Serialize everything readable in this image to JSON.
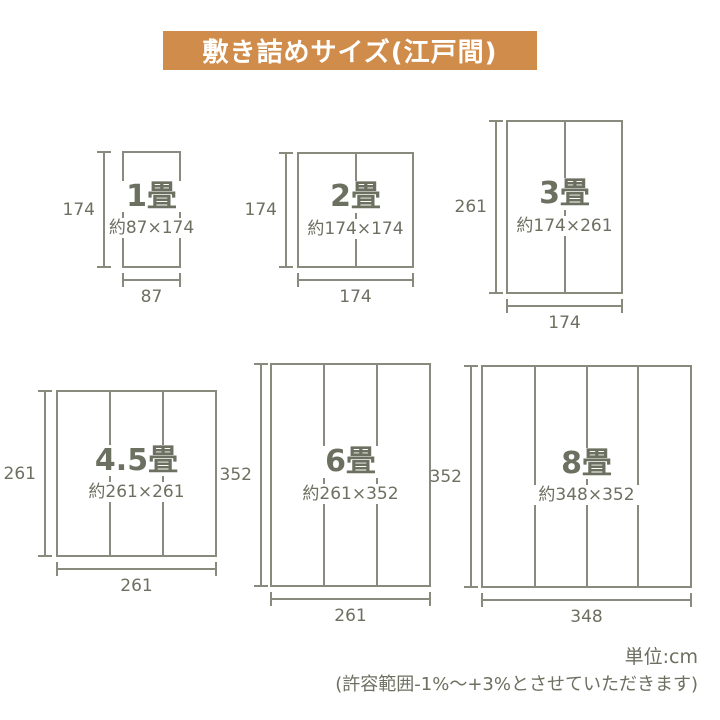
{
  "title": "敷き詰めサイズ(江戸間)",
  "colors": {
    "banner_bg": "#d08c4a",
    "title_text": "#ffffff",
    "line": "#878a7c",
    "text": "#6c7060"
  },
  "diagrams": [
    {
      "label": "1畳",
      "size": "約87×174",
      "side_cm": "174",
      "bottom_cm": "87",
      "columns": 1
    },
    {
      "label": "2畳",
      "size": "約174×174",
      "side_cm": "174",
      "bottom_cm": "174",
      "columns": 2
    },
    {
      "label": "3畳",
      "size": "約174×261",
      "side_cm": "261",
      "bottom_cm": "174",
      "columns": 2
    },
    {
      "label": "4.5畳",
      "size": "約261×261",
      "side_cm": "261",
      "bottom_cm": "261",
      "columns": 3
    },
    {
      "label": "6畳",
      "size": "約261×352",
      "side_cm": "352",
      "bottom_cm": "261",
      "columns": 3
    },
    {
      "label": "8畳",
      "size": "約348×352",
      "side_cm": "352",
      "bottom_cm": "348",
      "columns": 4
    }
  ],
  "footer": {
    "unit": "単位:cm",
    "tolerance": "(許容範囲-1%〜+3%とさせていただきます)"
  }
}
